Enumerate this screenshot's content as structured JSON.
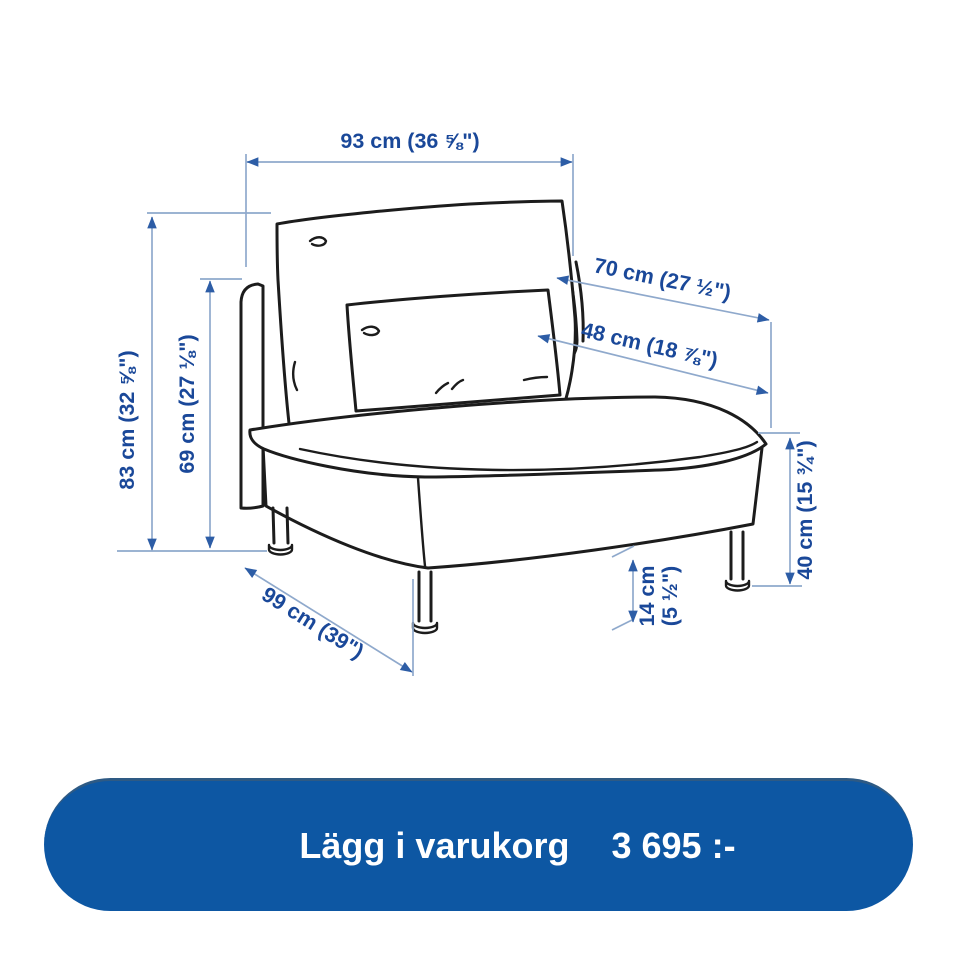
{
  "diagram": {
    "dims": {
      "width_overall": "93 cm (36 ⅝\")",
      "height_overall": "83 cm (32 ⅝\")",
      "height_backrest": "69 cm (27 ⅛\")",
      "depth_back_cushion": "70 cm (27 ½\")",
      "width_pillow": "48 cm (18 ⅞\")",
      "height_seat": "40 cm (15 ¾\")",
      "height_leg_line1": "14 cm",
      "height_leg_line2": "(5 ½\")",
      "depth_overall": "99 cm (39\")"
    }
  },
  "cart_button": {
    "label": "Lägg i varukorg",
    "price": "3 695 :-"
  },
  "colors": {
    "button_blue": "#0d57a3",
    "dim_text_blue": "#1a4899",
    "dim_line_blue": "#8fa9cc",
    "arrow_blue": "#2d5da6",
    "drawing_black": "#1c1c1c"
  }
}
